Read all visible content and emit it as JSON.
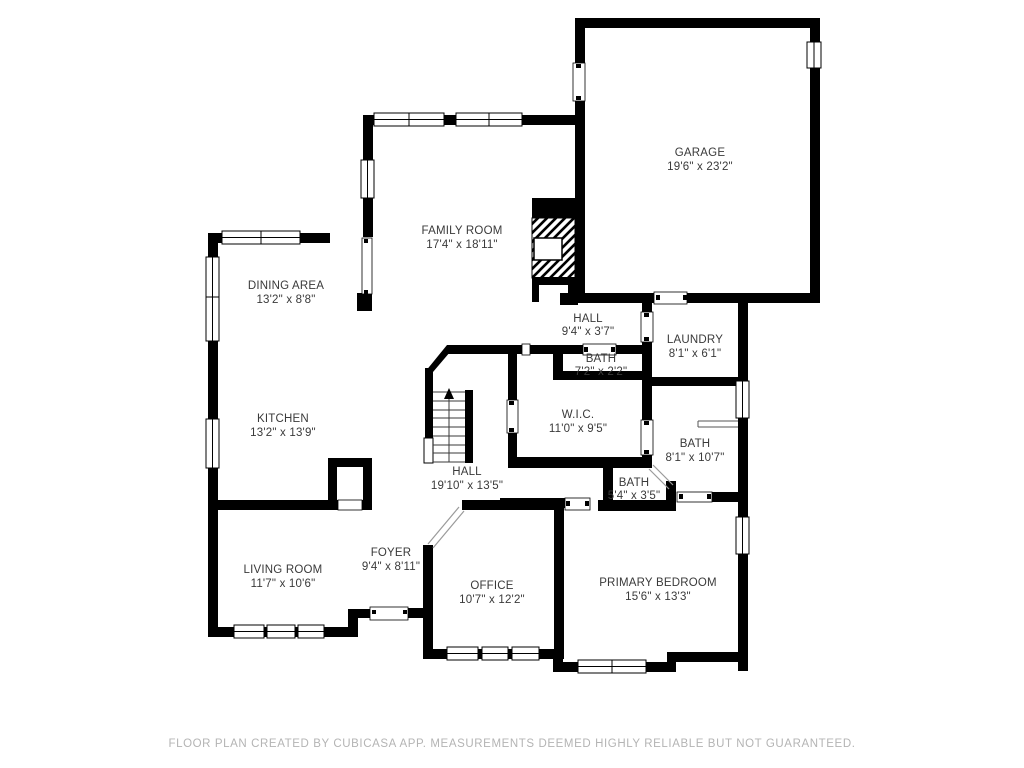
{
  "plan": {
    "title": "Residential floor plan",
    "rooms": [
      {
        "name": "GARAGE",
        "dims": "19'6\" x 23'2\""
      },
      {
        "name": "FAMILY ROOM",
        "dims": "17'4\" x 18'11\""
      },
      {
        "name": "DINING AREA",
        "dims": "13'2\" x 8'8\""
      },
      {
        "name": "HALL",
        "dims": "9'4\" x 3'7\""
      },
      {
        "name": "LAUNDRY",
        "dims": "8'1\" x 6'1\""
      },
      {
        "name": "BATH",
        "dims": "7'2\" x 2'2\""
      },
      {
        "name": "KITCHEN",
        "dims": "13'2\" x 13'9\""
      },
      {
        "name": "W.I.C.",
        "dims": "11'0\" x 9'5\""
      },
      {
        "name": "BATH",
        "dims": "8'1\" x 10'7\""
      },
      {
        "name": "HALL",
        "dims": "19'10\" x 13'5\""
      },
      {
        "name": "BATH",
        "dims": "5'4\" x 3'5\""
      },
      {
        "name": "LIVING ROOM",
        "dims": "11'7\" x 10'6\""
      },
      {
        "name": "FOYER",
        "dims": "9'4\" x 8'11\""
      },
      {
        "name": "OFFICE",
        "dims": "10'7\" x 12'2\""
      },
      {
        "name": "PRIMARY BEDROOM",
        "dims": "15'6\" x 13'3\""
      }
    ],
    "footer": "FLOOR PLAN CREATED BY CUBICASA APP. MEASUREMENTS DEEMED HIGHLY RELIABLE BUT NOT GUARANTEED.",
    "colors": {
      "walls": "#000000",
      "label_text": "#3a3a3a",
      "footer_text": "#b4b4b4",
      "background": "#ffffff"
    }
  }
}
